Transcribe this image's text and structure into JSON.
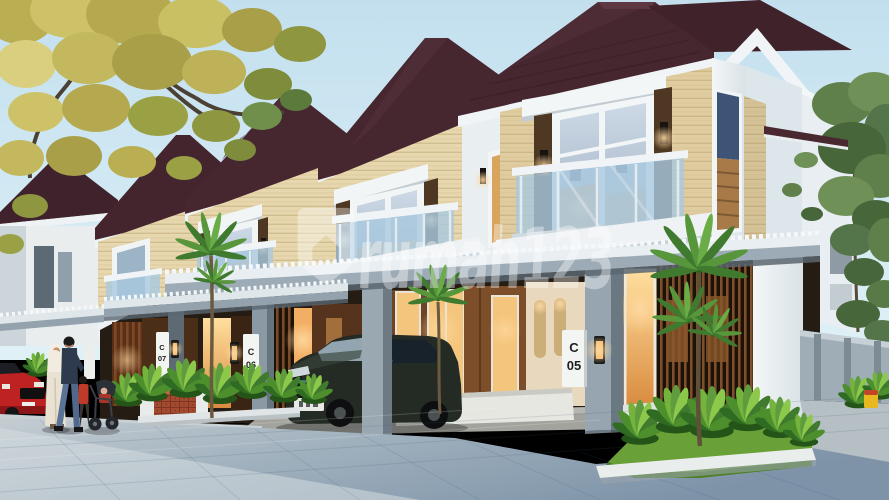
{
  "watermark": {
    "text": "rumah123",
    "icon": "house-pin-icon",
    "color": "#ffffff",
    "opacity": 0.38
  },
  "house_plaques": [
    {
      "letter": "C",
      "number": "05"
    },
    {
      "letter": "C",
      "number": "06"
    },
    {
      "letter": "C",
      "number": "07"
    }
  ],
  "palette": {
    "sky_top": "#c3dfee",
    "sky_bottom": "#e0f0f7",
    "roof": "#46262f",
    "roof_shadow": "#381d25",
    "fascia_white": "#f0f4f6",
    "stone": "#e6d7ae",
    "wood_pillar": "#4e3823",
    "balcony_glass": "#a9c9e0",
    "canopy_gray": "#9cabb6",
    "column_gray": "#97a5b0",
    "interior_dark": "#251c14",
    "wood_panel": "#7a4c28",
    "warm_light": "#f5b868",
    "pavement_light": "#c4cdd2",
    "pavement_dark": "#7e93a8",
    "grass": "#69a038",
    "leaf_green": "#4c8f2c",
    "autumn_leaf": "#c3b85e",
    "brick": "#a34a30",
    "suv_body": "#242b24",
    "car_red": "#bf2222"
  }
}
